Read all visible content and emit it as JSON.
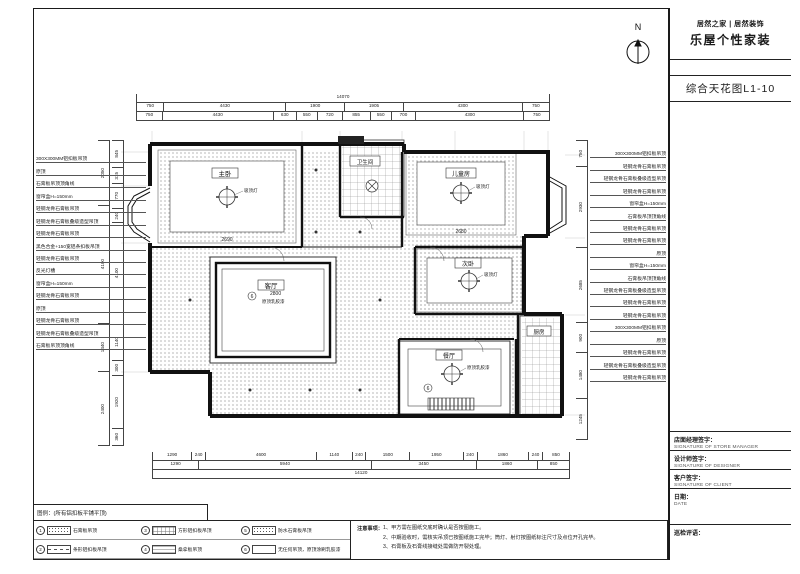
{
  "sheet": {
    "logo_brand": "居然之家 | 居然装饰",
    "logo_sub": "乐屋个性家装",
    "drawing_title": "综合天花图L1-10",
    "north_label": "N",
    "titleblock": [
      {
        "cn": "店面经理签字：",
        "en": "SIGNATURE OF STORE MANAGER"
      },
      {
        "cn": "设计师签字：",
        "en": "SIGNATURE OF DESIGNER"
      },
      {
        "cn": "客户签字：",
        "en": "SIGNATURE OF CLIENT"
      },
      {
        "cn": "日期：",
        "en": "DATE"
      },
      {
        "cn": "巡检评语：",
        "en": ""
      }
    ]
  },
  "labels": {
    "left": [
      "300X300MM铝扣板吊顶",
      "原顶",
      "石膏板吊顶顶角线",
      "窗帘盒H=150mm",
      "轻钢龙骨石膏板吊顶",
      "轻钢龙骨石膏板叠级造型吊顶",
      "轻钢龙骨石膏板吊顶",
      "黑色合金+150宽铝条扣板吊顶",
      "轻钢龙骨石膏板吊顶",
      "反光灯槽",
      "窗帘盒H=150mm",
      "轻钢龙骨石膏板吊顶",
      "原顶",
      "轻钢龙骨石膏板吊顶",
      "轻钢龙骨石膏板叠级造型吊顶",
      "石膏板吊顶顶角线"
    ],
    "right": [
      "300X300MM铝扣板吊顶",
      "轻钢龙骨石膏板吊顶",
      "轻钢龙骨石膏板叠级造型吊顶",
      "轻钢龙骨石膏板吊顶",
      "窗帘盒H=150mm",
      "石膏板吊顶顶角线",
      "轻钢龙骨石膏板吊顶",
      "轻钢龙骨石膏板吊顶",
      "原顶",
      "窗帘盒H=150mm",
      "石膏板吊顶顶角线",
      "轻钢龙骨石膏板叠级造型吊顶",
      "轻钢龙骨石膏板吊顶",
      "轻钢龙骨石膏板吊顶",
      "300X300MM铝扣板吊顶",
      "原顶",
      "轻钢龙骨石膏板吊顶",
      "轻钢龙骨石膏板叠级造型吊顶",
      "轻钢龙骨石膏板吊顶"
    ]
  },
  "dims": {
    "top_total": [
      "14070"
    ],
    "top_row1": [
      "750",
      "4430",
      "1900",
      "1905",
      "4300",
      "750"
    ],
    "top_row2": [
      "750",
      "4430",
      "630",
      "550",
      "720",
      "855",
      "550",
      "700",
      "4300",
      "750"
    ],
    "bottom_row1": [
      "1290",
      "240",
      "4600",
      "1140",
      "240",
      "1500",
      "1950",
      "240",
      "1860",
      "240",
      "850"
    ],
    "bottom_row2": [
      "1290",
      "5940",
      "3450",
      "1860",
      "850"
    ],
    "bottom_total": [
      "14120"
    ],
    "left_chainA": [
      "845",
      "315",
      "770",
      "240",
      "4100",
      "1140",
      "300",
      "1920",
      "360"
    ],
    "left_chainB": [
      "2050",
      "4100",
      "1440",
      "2400"
    ],
    "right_chain": [
      "750",
      "2930",
      "2685",
      "900",
      "1480",
      "1245"
    ]
  },
  "rooms": [
    {
      "name": "主卧",
      "lamp": "吸顶灯",
      "dim": "2690"
    },
    {
      "name": "卫生间",
      "lamp": "",
      "dim": ""
    },
    {
      "name": "儿童房",
      "lamp": "吸顶灯",
      "dim": "2680"
    },
    {
      "name": "次卧",
      "lamp": "吸顶灯",
      "dim": ""
    },
    {
      "name": "客厅",
      "note": "原顶乳胶漆",
      "dim": "2800",
      "marker": "6"
    },
    {
      "name": "餐厅",
      "note": "原顶乳胶漆",
      "dim": "",
      "marker": "6"
    },
    {
      "name": "厨房",
      "lamp": "",
      "dim": ""
    }
  ],
  "legend": {
    "title": "图例：(所有铝扣板平铺平顶)",
    "items": [
      {
        "num": "1",
        "label": "石膏板吊顶",
        "swatch": "dots"
      },
      {
        "num": "2",
        "label": "条形铝扣板吊顶",
        "swatch": "dash"
      },
      {
        "num": "3",
        "label": "方形铝扣板吊顶",
        "swatch": "grid"
      },
      {
        "num": "4",
        "label": "桑拿板吊顶",
        "swatch": "lines"
      },
      {
        "num": "5",
        "label": "防水石膏板吊顶",
        "swatch": "dots"
      },
      {
        "num": "6",
        "label": "无任何吊顶，原顶涂刷乳胶漆",
        "swatch": "empty"
      }
    ]
  },
  "notes": {
    "heading": "注意事项：",
    "lines": [
      "1、甲方需在图纸交底时确认是否按图施工。",
      "2、中期验收时，需核实吊顶已按图纸施工完毕；筒灯、射灯按图纸标注尺寸及点位开孔完毕。",
      "3、石膏板及石膏线接缝处需做防开裂处理。"
    ]
  }
}
